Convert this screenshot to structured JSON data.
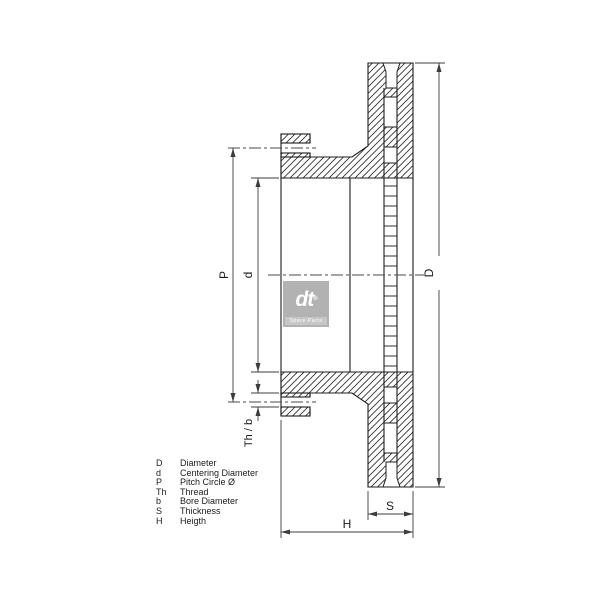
{
  "drawing": {
    "labels": {
      "pitch_circle": "P",
      "centering_diameter": "d",
      "outer_diameter": "D",
      "thickness": "S",
      "height": "H",
      "thread_bore": "Th / b"
    },
    "line_color": "#1c1c1c",
    "dimension_color": "#3c3c3c"
  },
  "legend": {
    "items": [
      {
        "symbol": "D",
        "description": "Diameter"
      },
      {
        "symbol": "d",
        "description": "Centering Diameter"
      },
      {
        "symbol": "P",
        "description": "Pitch Circle Ø"
      },
      {
        "symbol": "Th",
        "description": "Thread"
      },
      {
        "symbol": "b",
        "description": "Bore Diameter"
      },
      {
        "symbol": "S",
        "description": "Thickness"
      },
      {
        "symbol": "H",
        "description": "Heigth"
      }
    ]
  },
  "logo": {
    "brand": "dt",
    "registered": "®",
    "subtitle": "Spare Parts",
    "box_color": "#b2b2b2"
  }
}
